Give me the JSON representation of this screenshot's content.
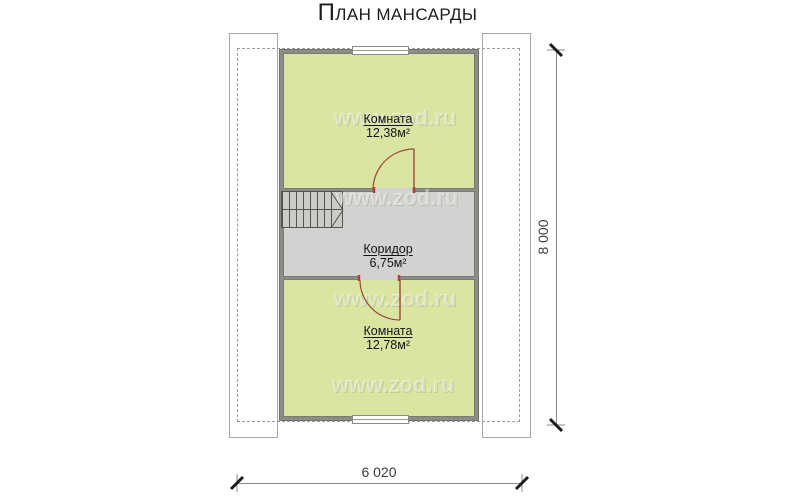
{
  "title": "План мансарды",
  "watermark": "www.zod.ru",
  "plan": {
    "rooms": [
      {
        "id": "room-top",
        "name": "Комната",
        "area": "12,38м²"
      },
      {
        "id": "corridor",
        "name": "Коридор",
        "area": "6,75м²"
      },
      {
        "id": "room-bottom",
        "name": "Комната",
        "area": "12,78м²"
      }
    ]
  },
  "dimensions": {
    "vertical": "8 000",
    "horizontal": "6 020"
  },
  "colors": {
    "room_fill": "#d9e5a1",
    "corridor_fill": "#d2d2d0",
    "wall": "#8d8d87",
    "door_arc": "#9b4a3a",
    "door_jamb": "#b23c2e",
    "dashed_roof": "#9b9b99",
    "dimension_text": "#3f3b38"
  }
}
